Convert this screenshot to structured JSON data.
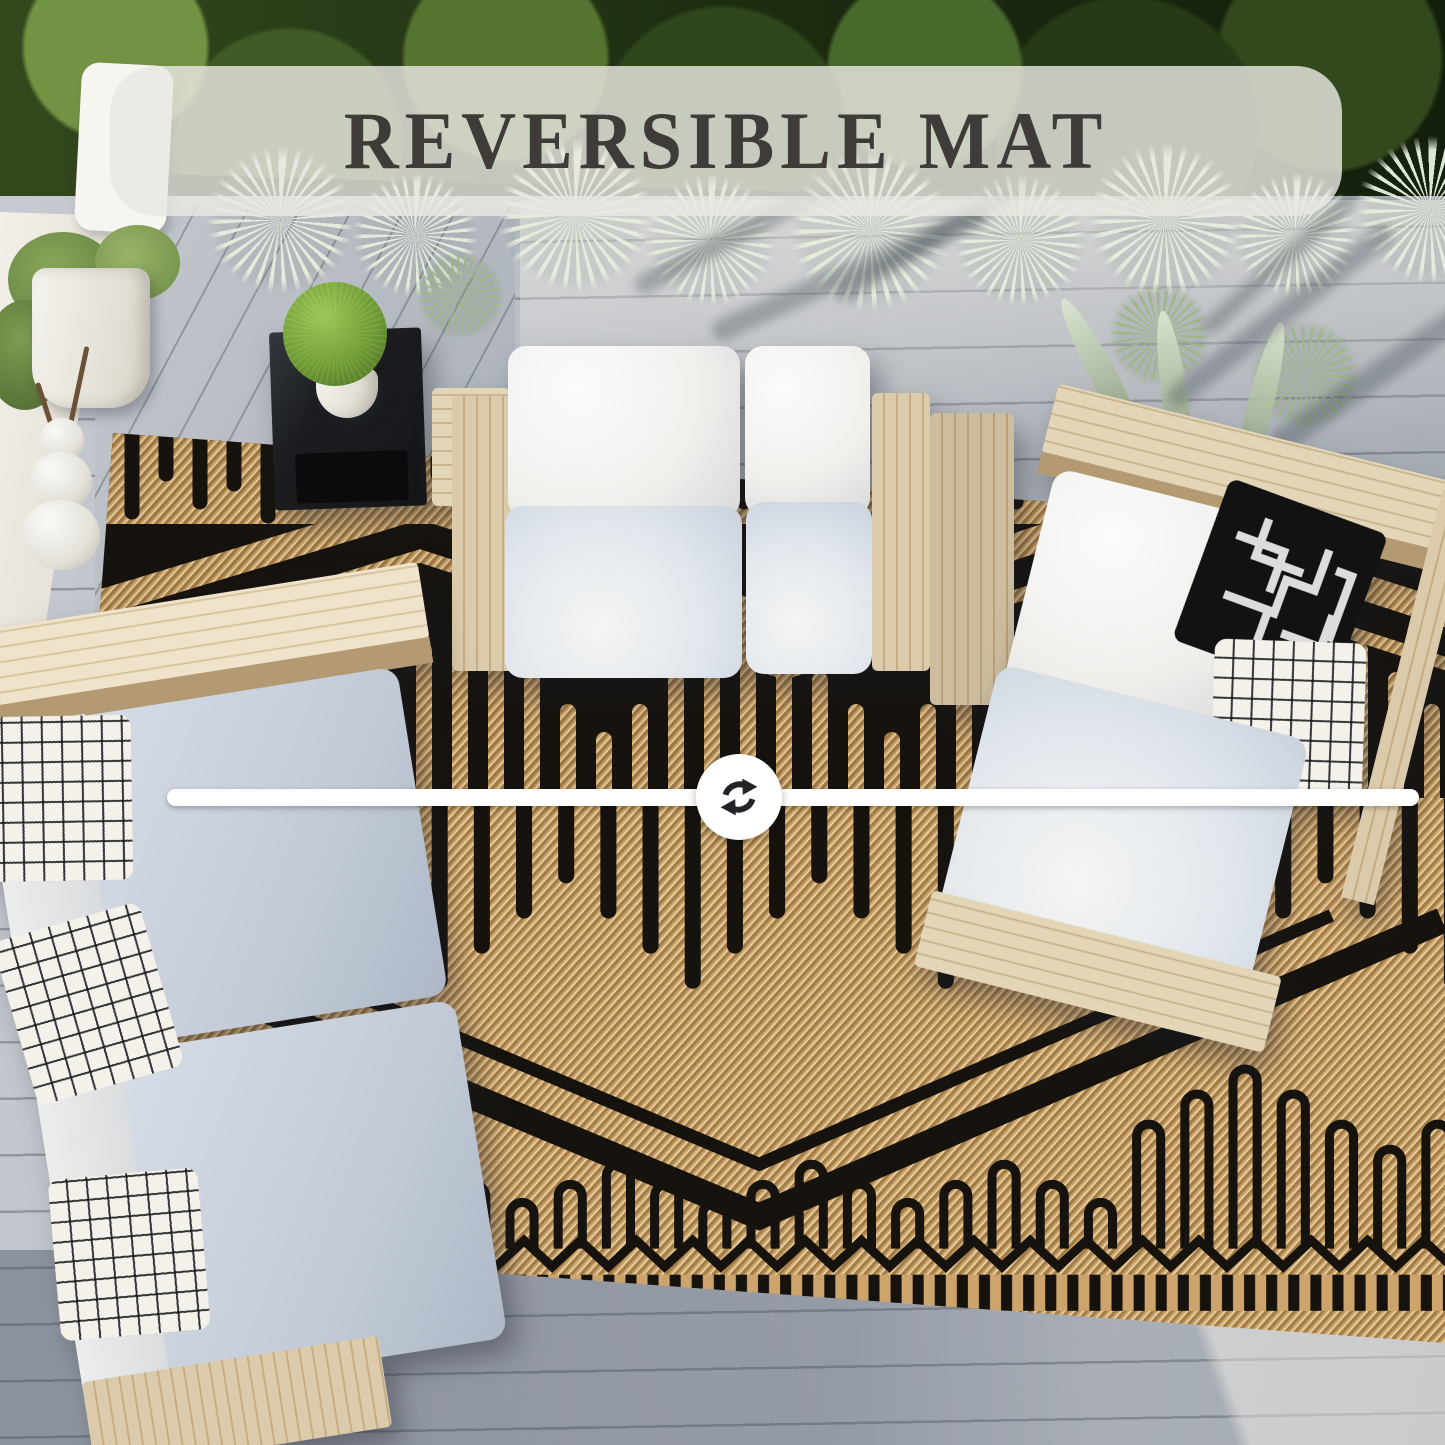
{
  "image_type": "product-photo-overhead-patio",
  "banner": {
    "label": "REVERSIBLE MAT",
    "background": "#e9e8e2",
    "text_color": "#3e3b39"
  },
  "divider": {
    "icon": "reverse-arrows-icon",
    "line_color": "#ffffff",
    "circle_color": "#ffffff",
    "icon_color": "#232428"
  },
  "rug": {
    "top_side": {
      "base": "#16130e",
      "accent": "#c79e66",
      "pattern": "tan geometric loops and chevrons on black"
    },
    "bottom_side": {
      "base": "#cda46c",
      "accent": "#16130e",
      "pattern": "black geometric loops and chevrons on tan"
    }
  },
  "scene": {
    "deck_color": "#b9bec6",
    "hedge_color": "#2c421a",
    "cushion_color": "#eef0f2",
    "wood_color": "#d9c7a4"
  }
}
